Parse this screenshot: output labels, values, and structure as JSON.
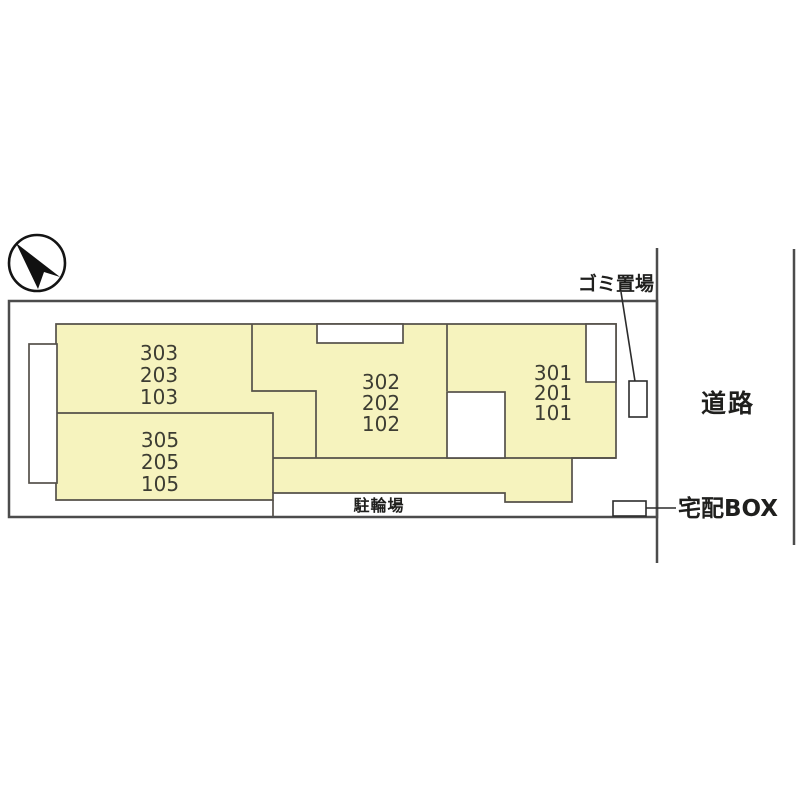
{
  "site_plan": {
    "compass_icon": "north-arrow",
    "buildings": [
      {
        "name": "left-upper",
        "units": [
          "303",
          "203",
          "103"
        ]
      },
      {
        "name": "middle",
        "units": [
          "302",
          "202",
          "102"
        ]
      },
      {
        "name": "right",
        "units": [
          "301",
          "201",
          "101"
        ]
      },
      {
        "name": "left-lower",
        "units": [
          "305",
          "205",
          "105"
        ]
      }
    ],
    "labels": {
      "garbage_area": "ゴミ置場",
      "road": "道路",
      "delivery_box": "宅配BOX",
      "bicycle_parking": "駐輪場"
    },
    "colors": {
      "building_fill": "#f6f3be",
      "building_outline": "#55514a",
      "boundary": "#4c4c4c",
      "label_text": "#1f1f1d",
      "unit_text": "#3d3d33"
    }
  }
}
